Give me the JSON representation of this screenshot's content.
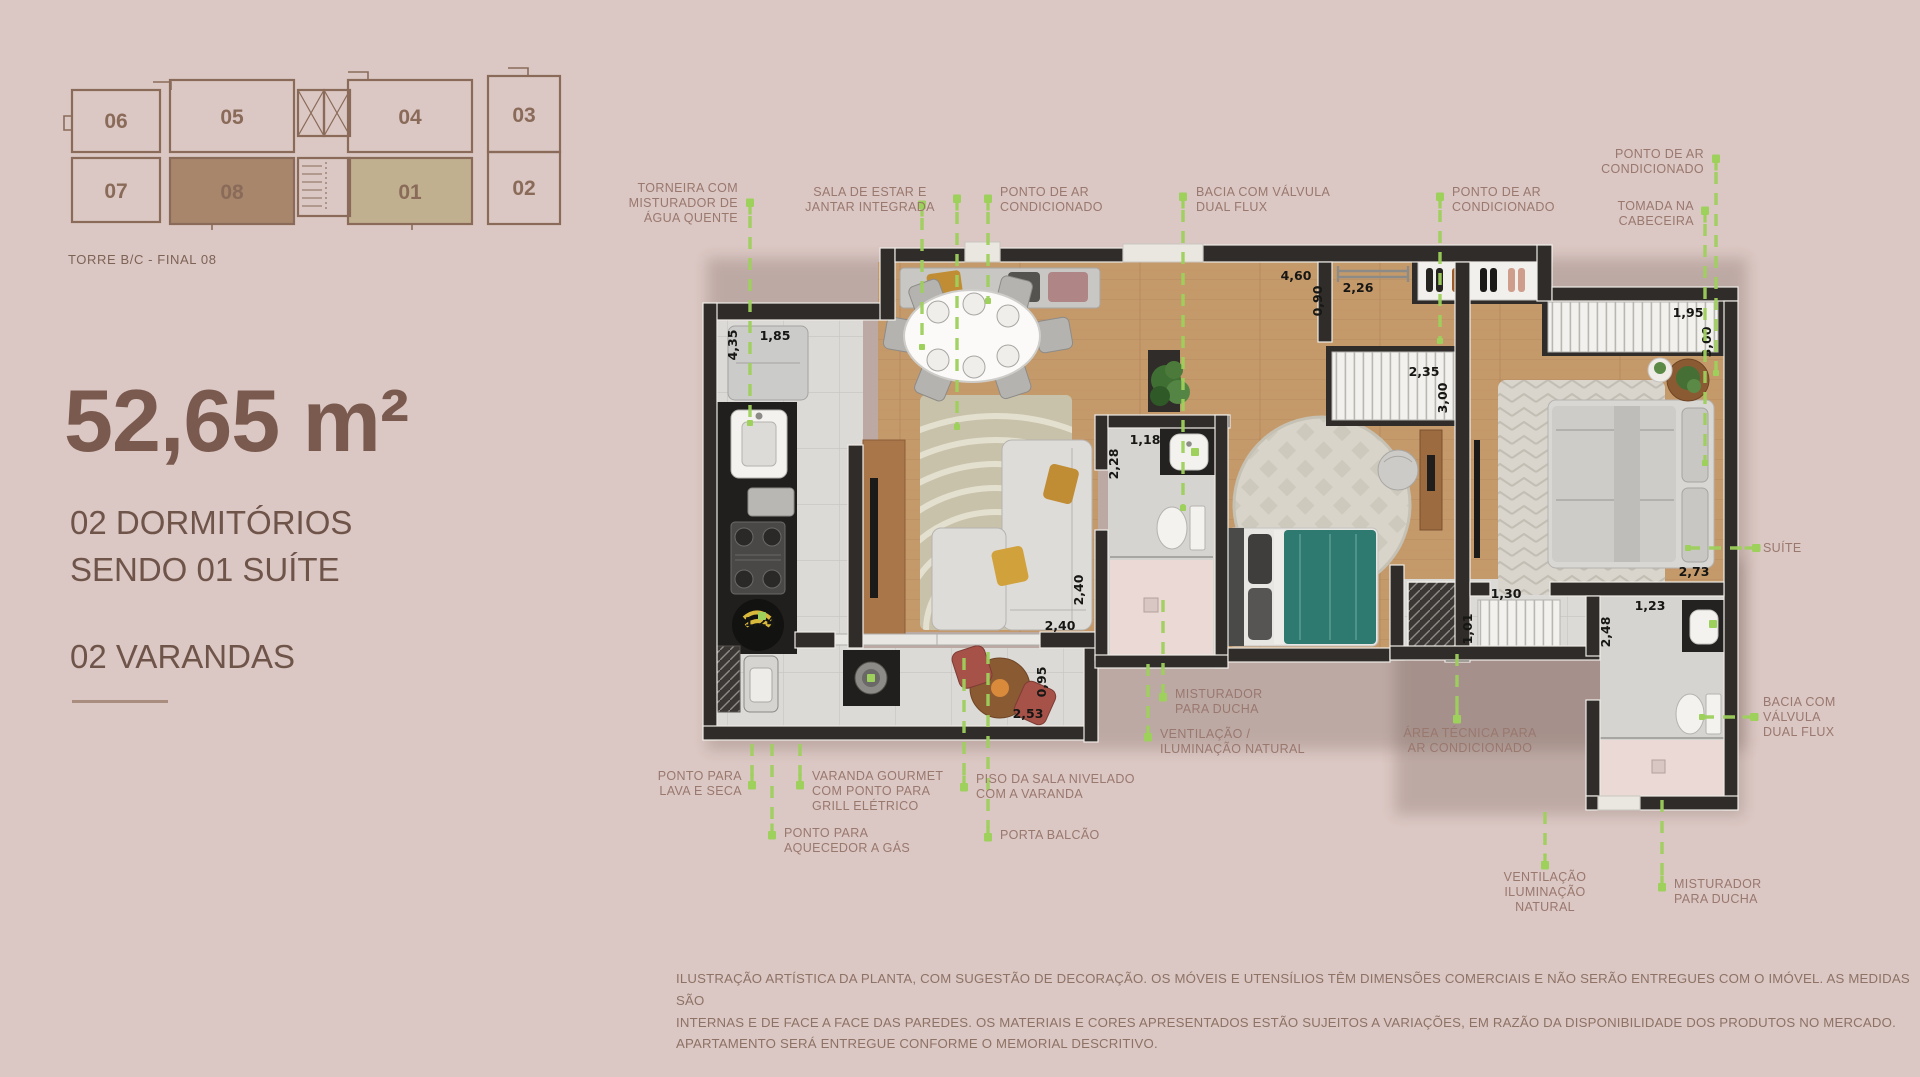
{
  "key_plan": {
    "title": "TORRE B/C - FINAL 08",
    "units": [
      "06",
      "05",
      "04",
      "03",
      "07",
      "08",
      "01",
      "02"
    ],
    "highlight_unit": "08",
    "secondary_unit": "01"
  },
  "summary": {
    "area": "52,65 m²",
    "line1": "02 DORMITÓRIOS",
    "line2": "SENDO 01 SUÍTE",
    "line3": "02 VARANDAS"
  },
  "callouts": {
    "torneira": [
      "TORNEIRA COM",
      "MISTURADOR DE",
      "ÁGUA QUENTE"
    ],
    "sala": [
      "SALA DE ESTAR E",
      "JANTAR INTEGRADA"
    ],
    "ponto_ar_1": [
      "PONTO DE AR",
      "CONDICIONADO"
    ],
    "bacia_top": [
      "BACIA COM VÁLVULA",
      "DUAL FLUX"
    ],
    "ponto_ar_2": [
      "PONTO DE AR",
      "CONDICIONADO"
    ],
    "ponto_ar_3": [
      "PONTO DE AR",
      "CONDICIONADO"
    ],
    "tomada": [
      "TOMADA NA",
      "CABECEIRA"
    ],
    "suite": "SUÍTE",
    "bacia_right": [
      "BACIA COM",
      "VÁLVULA",
      "DUAL FLUX"
    ],
    "lava_seca": [
      "PONTO PARA",
      "LAVA E SECA"
    ],
    "varanda_gourmet": [
      "VARANDA GOURMET",
      "COM PONTO PARA",
      "GRILL ELÉTRICO"
    ],
    "aquecedor": [
      "PONTO PARA",
      "AQUECEDOR A GÁS"
    ],
    "piso_sala": [
      "PISO DA SALA NIVELADO",
      "COM A VARANDA"
    ],
    "porta_balcao": "PORTA BALCÃO",
    "misturador_centro": [
      "MISTURADOR",
      "PARA DUCHA"
    ],
    "ventilacao_centro": [
      "VENTILAÇÃO /",
      "ILUMINAÇÃO NATURAL"
    ],
    "area_tecnica": [
      "ÁREA TÉCNICA PARA",
      "AR CONDICIONADO"
    ],
    "ventilacao_dir": [
      "VENTILAÇÃO",
      "ILUMINAÇÃO",
      "NATURAL"
    ],
    "misturador_dir": [
      "MISTURADOR",
      "PARA DUCHA"
    ]
  },
  "dimensions": {
    "kitchen_depth": "4,35",
    "kitchen_width": "1,85",
    "kitchen_aisle": "1,24",
    "hall_length": "4,60",
    "hall_width": "0,90",
    "rail": "2,26",
    "wardrobe2": "2,35",
    "dorm2_depth": "3,00",
    "suite_wardrobe": "1,95",
    "suite_depth": "3,00",
    "bath_width": "1,18",
    "bath_depth": "2,28",
    "living_depth": "2,40",
    "living_width": "2,40",
    "varanda_depth": "0,95",
    "varanda_width": "2,53",
    "suite_width": "2,73",
    "closet": "1,30",
    "closet_depth": "1,01",
    "suitebath_depth": "2,48",
    "suitebath_width": "1,23"
  },
  "disclaimer": [
    "ILUSTRAÇÃO ARTÍSTICA DA PLANTA, COM SUGESTÃO DE DECORAÇÃO. OS MÓVEIS E UTENSÍLIOS TÊM DIMENSÕES COMERCIAIS E NÃO SERÃO ENTREGUES COM O IMÓVEL. AS MEDIDAS SÃO",
    "INTERNAS E DE FACE A FACE DAS PAREDES. OS MATERIAIS E CORES APRESENTADOS ESTÃO SUJEITOS A VARIAÇÕES, EM RAZÃO DA DISPONIBILIDADE DOS PRODUTOS NO MERCADO.",
    "APARTAMENTO SERÁ ENTREGUE CONFORME O MEMORIAL DESCRITIVO."
  ]
}
